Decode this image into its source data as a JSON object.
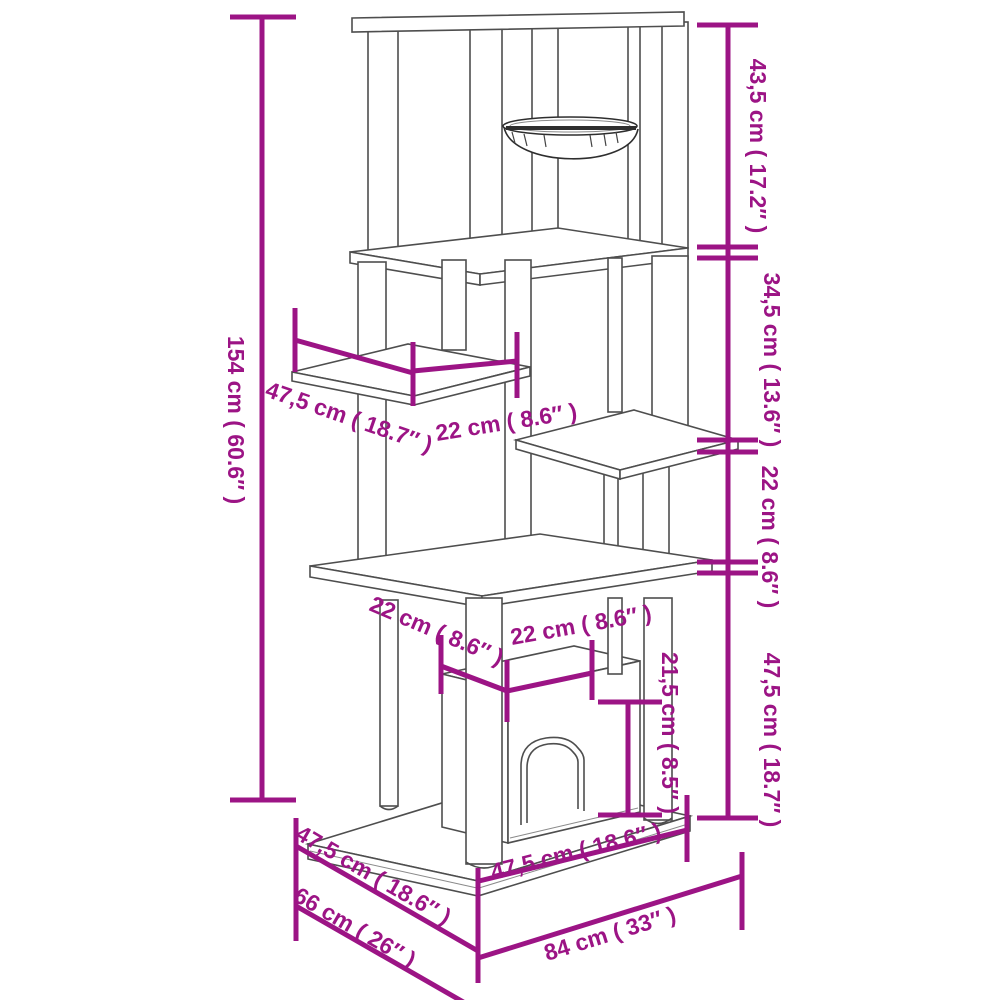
{
  "diagram": {
    "subject": "Cat tree with scratching posts, hanging basket, platforms, cat house and base — dimension drawing",
    "accent_color": "#9c1485",
    "line_color": "#4e4e4e",
    "background": "#ffffff"
  },
  "dimensions": {
    "total_height": "154 cm ( 60.6″ )",
    "top_section_height": "43,5 cm ( 17.2″ )",
    "second_section_height": "34,5 cm ( 13.6″ )",
    "third_section_height": "22 cm ( 8.6″ )",
    "bottom_section_height": "47,5 cm ( 18.7″ )",
    "left_platform_depth": "47,5 cm ( 18.7″ )",
    "platform_width": "22 cm ( 8.6″ )",
    "house_depth": "22 cm ( 8.6″ )",
    "house_width": "22 cm ( 8.6″ )",
    "door_height": "21,5 cm ( 8.5″ )",
    "base_depth": "47,5 cm ( 18.6″ )",
    "base_total_depth": "66 cm ( 26″ )",
    "base_width": "47,5 cm ( 18.6″ )",
    "base_total_width": "84 cm ( 33″ )"
  }
}
